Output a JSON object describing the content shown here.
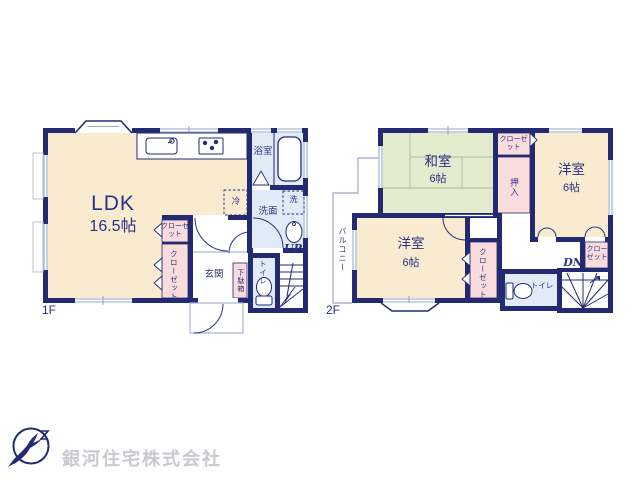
{
  "floor1": {
    "floor_label": "1F",
    "ldk": {
      "name": "LDK",
      "size": "16.5帖"
    },
    "bath": "浴室",
    "washroom": "洗面",
    "washer": "洗",
    "fridge": "冷",
    "closet_upper": "クローゼット",
    "closet_lower": "クローゼット",
    "entrance": "玄関",
    "shoe_cabinet": "下駄箱",
    "toilet": "トイレ",
    "stairs_up": "UP"
  },
  "floor2": {
    "floor_label": "2F",
    "japanese_room": {
      "name": "和室",
      "size": "6帖"
    },
    "western_room_right": {
      "name": "洋室",
      "size": "6帖"
    },
    "western_room_left": {
      "name": "洋室",
      "size": "6帖"
    },
    "closet_top": "クローゼット",
    "oshiire": "押入",
    "closet_left": "クローゼット",
    "closet_right": "クローゼット",
    "balcony": "バルコニー",
    "toilet": "トイレ",
    "stairs_down": "DN"
  },
  "company": {
    "name": "銀河住宅株式会社"
  },
  "colors": {
    "wall": "#232a72",
    "label": "#2b3185",
    "room_cream": "#f9ebcf",
    "room_green": "#e4ecd0",
    "room_blue": "#e0ebf7",
    "room_pink": "#fadcdc",
    "window_line": "#9aa6cc",
    "tatami_line": "#b7c49e",
    "watermark": "#c9c9cf"
  }
}
